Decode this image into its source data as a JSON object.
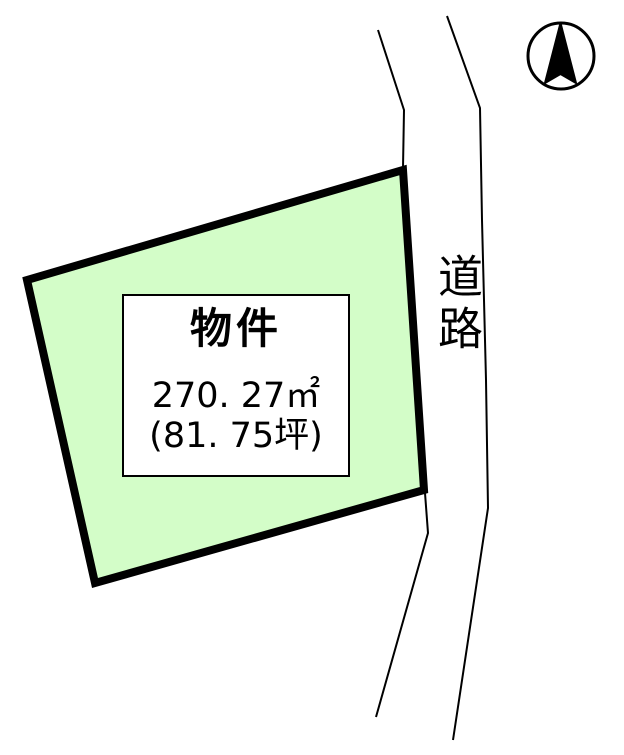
{
  "diagram": {
    "kind": "land-plot-map",
    "parcel": {
      "name_label": "物件",
      "area_sqm": "270. 27㎡",
      "area_tsubo": "(81. 75坪)"
    },
    "road": {
      "label": "道路"
    },
    "compass": {
      "icon": "north-arrow"
    }
  },
  "colors": {
    "parcel_fill": "#d3fdc8",
    "line": "#000000",
    "background": "#ffffff"
  }
}
